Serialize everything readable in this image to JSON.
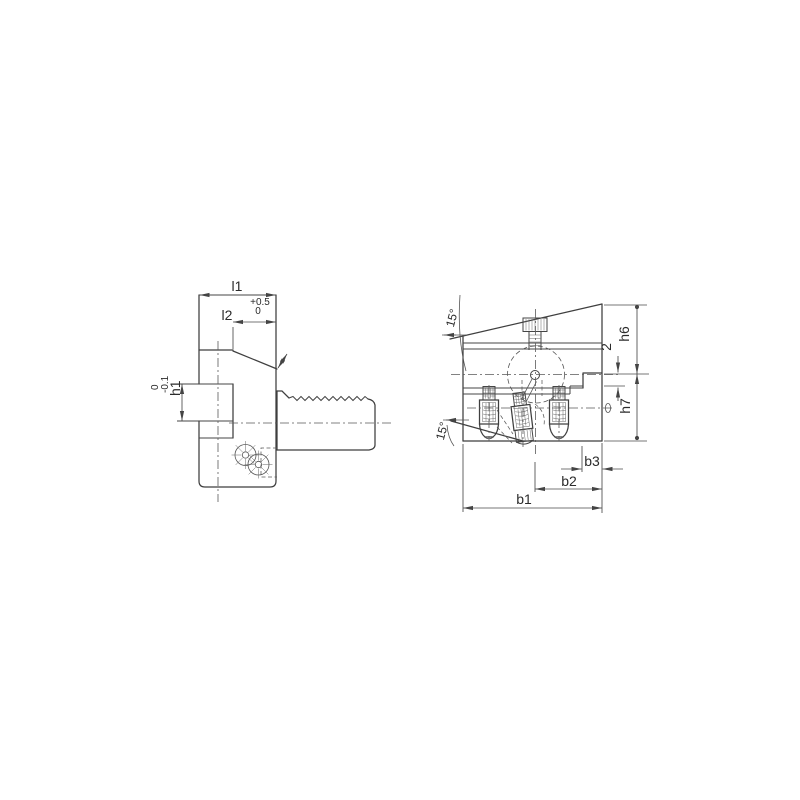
{
  "drawing": {
    "side_view": {
      "l1": "l1",
      "l2": "l2",
      "l2_tol_upper": "+0.5",
      "l2_tol_lower": "0",
      "h1": "h1",
      "h1_tol_upper": "0",
      "h1_tol_lower": "-0.1"
    },
    "front_view": {
      "angle_top": "15°",
      "angle_bottom": "15°",
      "step": "2",
      "h6": "h6",
      "h7": "h7",
      "b1": "b1",
      "b2": "b2",
      "b3": "b3"
    },
    "colors": {
      "line": "#3f3f3f",
      "thin_line": "#5a5a5a",
      "text": "#2b2b2b",
      "background": "#ffffff"
    }
  }
}
